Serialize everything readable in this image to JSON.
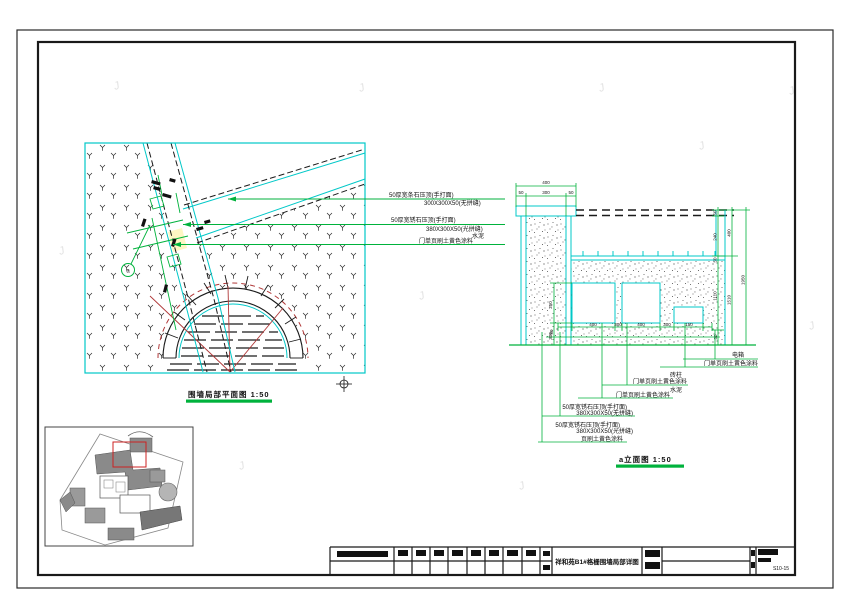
{
  "watermark": "J",
  "colors": {
    "line_cyan": "#00c8c8",
    "line_green": "#00b23c",
    "line_red": "#b03838",
    "highlight_red": "#cc2222",
    "path_highlight_yellow": "#fdf6c3"
  },
  "plan": {
    "title": "围墙局部平面图 1:50",
    "section_marker": "a",
    "labels": {
      "l1a": "50厚宽条石压顶(手打面)",
      "l1b": "300X300X50(无拼缝)",
      "l2a": "50厚宽锈石压顶(手打面)",
      "l2b": "380X300X50(光拼缝)",
      "l2c": "水泥",
      "l2d": "门单页刷土黄色涂料"
    }
  },
  "section": {
    "title": "a立面图 1:50",
    "dims": {
      "top_total": "400",
      "top_left": "50",
      "top_mid": "300",
      "top_right": "50",
      "bottom": [
        "400",
        "300",
        "400",
        "300",
        "150"
      ],
      "bottom_left": "50",
      "bottom_right": "50",
      "left_upper": "250",
      "left_lower": "300",
      "right_r1": "50",
      "right_r2": "240",
      "right_r3": "50",
      "right_r4": "1110",
      "right_m1": "400",
      "right_m2": "1510",
      "right_o1": "1950"
    },
    "labels": {
      "elec": "电箱",
      "paint1": "门单页刷土黄色涂料",
      "pillar": "砖柱",
      "paint2": "门单页刷土黄色涂料",
      "cement": "水泥",
      "paint3": "门单页刷土黄色涂料",
      "coping1a": "50厚宽锈石压顶(手打面)",
      "coping1b": "380X300X50(无拼缝)",
      "coping2a": "50厚宽锈石压顶(手打面)",
      "coping2b": "380X300X50(光拼缝)",
      "coping2c": "页刷土黄色涂料"
    }
  },
  "titleblock": {
    "drawing_title": "祥和苑B1#格栅围墙局部详图",
    "sheet_no": "S10-15"
  }
}
